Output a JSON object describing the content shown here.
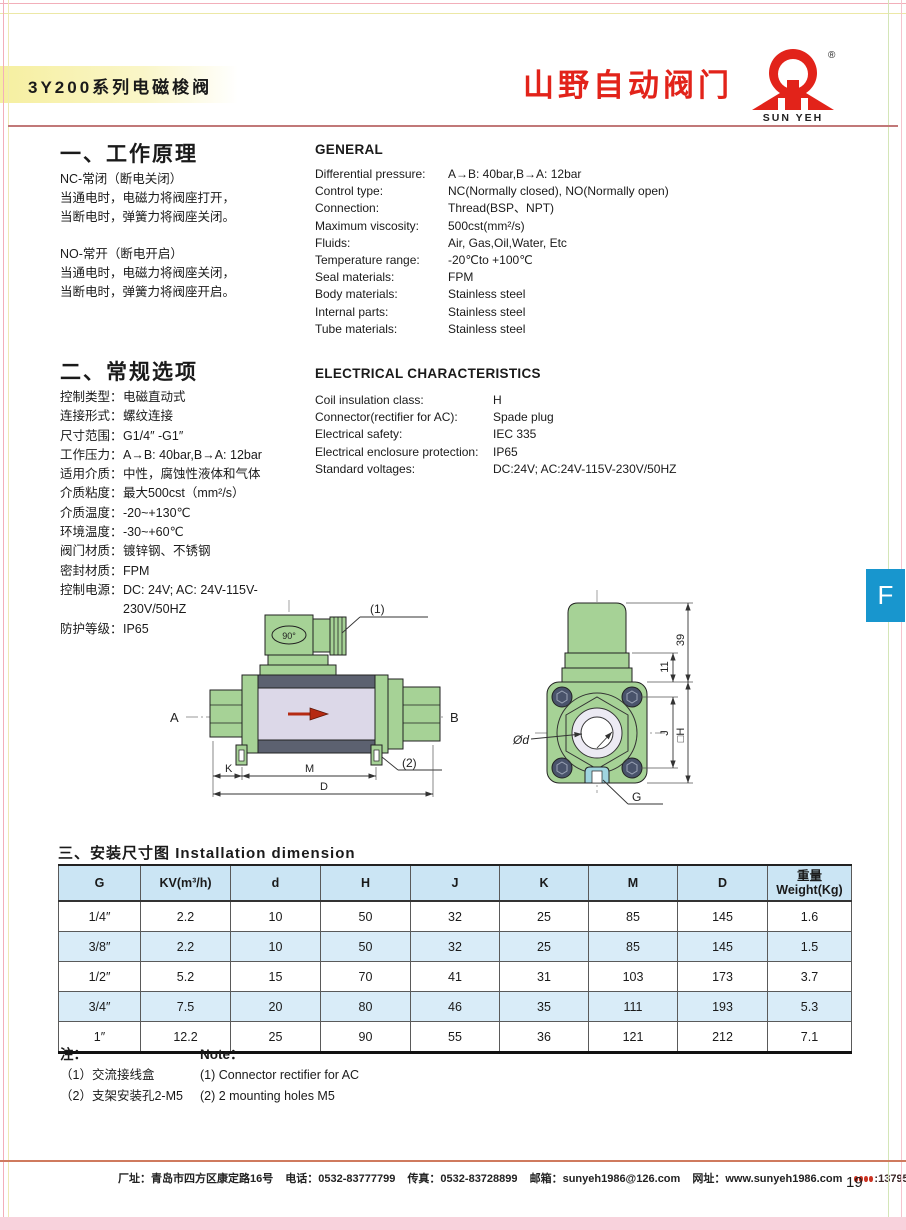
{
  "header": {
    "title": "3Y200系列电磁梭阀",
    "brand": "山野自动阀门",
    "brand_sub": "SUN YEH",
    "registered": "®"
  },
  "principle": {
    "heading": "一、工作原理",
    "nc_lines": [
      "NC-常闭（断电关闭）",
      "当通电时，电磁力将阀座打开，",
      "当断电时，弹簧力将阀座关闭。"
    ],
    "no_lines": [
      "NO-常开（断电开启）",
      "当通电时，电磁力将阀座关闭，",
      "当断电时，弹簧力将阀座开启。"
    ]
  },
  "general": {
    "heading": "GENERAL",
    "rows": [
      {
        "label": "Differential pressure:",
        "value": "A→B: 40bar,B→A: 12bar"
      },
      {
        "label": "Control type:",
        "value": "NC(Normally closed), NO(Normally open)"
      },
      {
        "label": "Connection:",
        "value": "Thread(BSP、NPT)"
      },
      {
        "label": "Maximum viscosity:",
        "value": "500cst(mm²/s)"
      },
      {
        "label": "Fluids:",
        "value": "Air, Gas,Oil,Water, Etc"
      },
      {
        "label": "Temperature range:",
        "value": "-20℃to +100℃"
      },
      {
        "label": "Seal materials:",
        "value": "FPM"
      },
      {
        "label": "Body materials:",
        "value": "Stainless steel"
      },
      {
        "label": "Internal parts:",
        "value": "Stainless steel"
      },
      {
        "label": "Tube materials:",
        "value": "Stainless steel"
      }
    ]
  },
  "options": {
    "heading": "二、常规选项",
    "rows": [
      {
        "label": "控制类型：",
        "value": "电磁直动式"
      },
      {
        "label": "连接形式：",
        "value": "螺纹连接"
      },
      {
        "label": "尺寸范围：",
        "value": "G1/4″ -G1″"
      },
      {
        "label": "工作压力：",
        "value": "A→B: 40bar,B→A: 12bar"
      },
      {
        "label": "适用介质：",
        "value": "中性，腐蚀性液体和气体"
      },
      {
        "label": "介质粘度：",
        "value": "最大500cst（mm²/s）"
      },
      {
        "label": "介质温度：",
        "value": "-20~+130℃"
      },
      {
        "label": "环境温度：",
        "value": "-30~+60℃"
      },
      {
        "label": "阀门材质：",
        "value": "镀锌钢、不锈钢"
      },
      {
        "label": "密封材质：",
        "value": "FPM"
      },
      {
        "label": "控制电源：",
        "value": "DC: 24V; AC: 24V-115V-230V/50HZ"
      },
      {
        "label": "防护等级：",
        "value": "IP65"
      }
    ]
  },
  "electrical": {
    "heading": "ELECTRICAL CHARACTERISTICS",
    "rows": [
      {
        "label": "Coil insulation class:",
        "value": "H"
      },
      {
        "label": "Connector(rectifier for AC):",
        "value": "Spade plug"
      },
      {
        "label": "Electrical safety:",
        "value": "IEC 335"
      },
      {
        "label": "Electrical enclosure protection:",
        "value": "IP65"
      },
      {
        "label": "Standard voltages:",
        "value": "DC:24V; AC:24V-115V-230V/50HZ"
      }
    ]
  },
  "side_tab": {
    "label": "F"
  },
  "drawing": {
    "side_view": {
      "port_a": "A",
      "port_b": "B",
      "angle": "90°",
      "callout1": "(1)",
      "callout2": "(2)",
      "dim_k": "K",
      "dim_m": "M",
      "dim_d": "D"
    },
    "end_view": {
      "dim_39": "39",
      "dim_11": "11",
      "dim_j": "J",
      "dim_h": "□H",
      "dim_od": "Ød",
      "dim_g": "G"
    }
  },
  "installation": {
    "heading_zh": "三、安装尺寸图",
    "heading_en": "Installation dimension",
    "columns": [
      "G",
      "KV(m³/h)",
      "d",
      "H",
      "J",
      "K",
      "M",
      "D"
    ],
    "weight_col": {
      "zh": "重量",
      "en": "Weight(Kg)"
    },
    "rows": [
      [
        "1/4″",
        "2.2",
        "10",
        "50",
        "32",
        "25",
        "85",
        "145",
        "1.6"
      ],
      [
        "3/8″",
        "2.2",
        "10",
        "50",
        "32",
        "25",
        "85",
        "145",
        "1.5"
      ],
      [
        "1/2″",
        "5.2",
        "15",
        "70",
        "41",
        "31",
        "103",
        "173",
        "3.7"
      ],
      [
        "3/4″",
        "7.5",
        "20",
        "80",
        "46",
        "35",
        "111",
        "193",
        "5.3"
      ],
      [
        "1″",
        "12.2",
        "25",
        "90",
        "55",
        "36",
        "121",
        "212",
        "7.1"
      ]
    ]
  },
  "notes": {
    "zh": {
      "heading": "注：",
      "items": [
        "（1）交流接线盒",
        "（2）支架安装孔2-M5"
      ]
    },
    "en": {
      "heading": "Note：",
      "items": [
        "(1) Connector rectifier for AC",
        "(2) 2 mounting holes M5"
      ]
    }
  },
  "footer": {
    "address": "厂址：青岛市四方区康定路16号",
    "phone": "电话：0532-83777799",
    "fax": "传真：0532-83728899",
    "email": "邮箱：sunyeh1986@126.com",
    "website": "网址：www.sunyeh1986.com",
    "mobile": ":1379528312",
    "page_number": "19"
  },
  "colors": {
    "brand_red": "#e2231a",
    "tab_blue": "#1896ce",
    "table_header_blue": "#cbe5f4",
    "table_alt_blue": "#d9ecf8",
    "drawing_green": "#a6d296",
    "drawing_lavender": "#dcd8e8",
    "drawing_dark_band": "#5c6170"
  }
}
